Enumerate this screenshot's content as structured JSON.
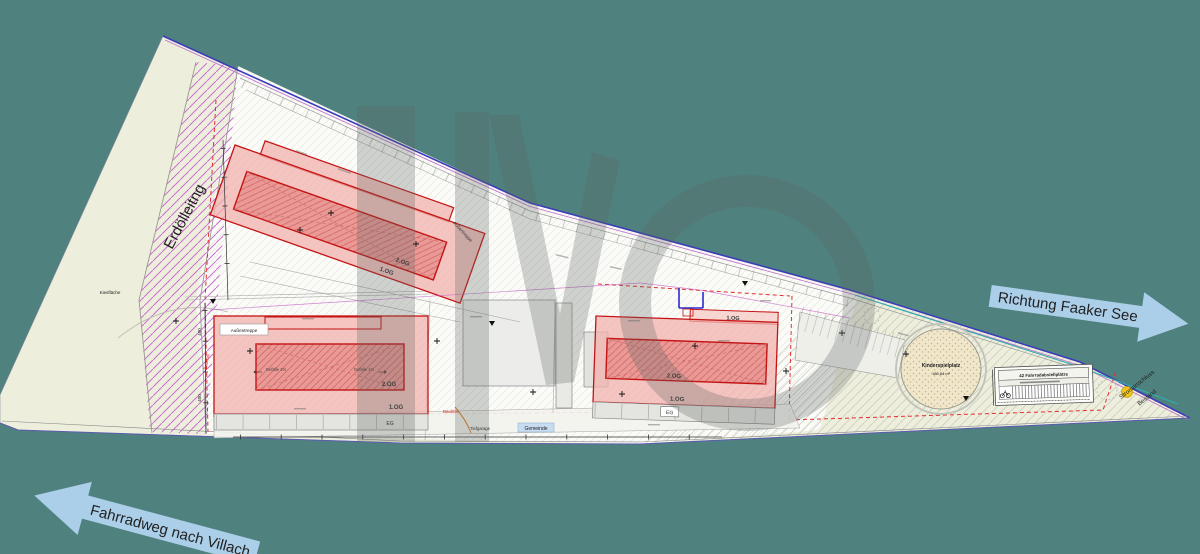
{
  "colors": {
    "background": "#4F827E",
    "plan_fill": "#EDEFDC",
    "built_zone_fill": "#FBFBF8",
    "building_stroke": "#C41414",
    "building_fill": "#F2B2AE",
    "building_inner_fill": "#E99A96",
    "hatch_magenta": "#C159CC",
    "boundary_blue": "#3B3BBB",
    "cyan_line": "#2FAFAF",
    "red_dashed": "#E03030",
    "arrow_fill": "#ABCEE9",
    "sand_fill": "#EFE6CB",
    "yellow_dot": "#F0C51E",
    "watermark_gray": "#5E6663"
  },
  "labels": {
    "erdoelleitung": "Erdölleitng",
    "kiesflaeche": "Kiesfläche",
    "aussentreppe": "Außentreppe",
    "baulinie": "Baulinie",
    "gefaelle": "Gefälle 1%",
    "gemeinde": "Gemeinde",
    "tiefgarage": "Tiefgarage",
    "kinderspielplatz": "Kinderspielplatz",
    "kinderspielplatz_area": "180,84 m²",
    "fahrradplaetze": "42 Fahrradabstellplätze",
    "stromanschluss_1": "Stromanschluss",
    "stromanschluss_2": "Bestand",
    "dim_a": "400",
    "dim_b": "400"
  },
  "levels": {
    "og2": "2.OG",
    "og1": "1.OG",
    "eg": "EG"
  },
  "arrows": {
    "faaker_see": "Richtung Faaker See",
    "villach": "Fahrradweg nach Villach"
  },
  "watermark": {
    "letters": "IMO"
  }
}
